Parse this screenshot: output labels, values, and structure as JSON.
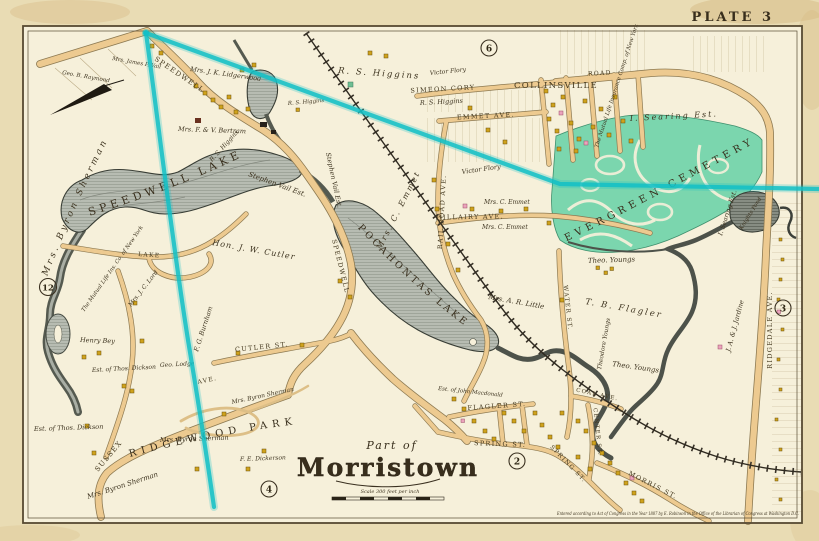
{
  "plate_label": "PLATE 3",
  "title": {
    "part_of": "Part of",
    "name": "Morristown",
    "scale_note": "Scale 300 feet per inch"
  },
  "copyright": "Entered according to Act of Congress in the Year 1887 by E. Robinson in the Office of the Librarian of Congress at Washington D.C.",
  "plate_refs": {
    "top": "6",
    "bottom": "2",
    "right": "3",
    "bottom_left": "4",
    "left": "12"
  },
  "colors": {
    "paper_margin": "#e7dab2",
    "map_background": "#f6f0da",
    "water_fill": "#b7bcb2",
    "water_dark": "#4d524a",
    "cemetery_green": "#7bd6ae",
    "road_fill": "#edca90",
    "overlay_cyan": "#12bfc6",
    "building_yellow": "#cfa21c",
    "building_pink": "#eba4bc",
    "ink": "#3a3020"
  },
  "labels": {
    "speedwell_lake": "SPEEDWELL LAKE",
    "pocahontas_lake": "POCAHONTAS LAKE",
    "evergreen_cemetery": "EVERGREEN CEMETERY",
    "ridgewood_park": "RIDGEWOOD PARK",
    "collinsville": "COLLINSVILLE",
    "knights_pond": "Knights Pond",
    "sherman_spread": "Mrs. Byron Sherman",
    "sherman1": "Mrs. Byron Sherman",
    "sherman2": "Mrs. Byron Sherman",
    "sherman3": "Mrs. Byron Sherman",
    "lidgerwood": "Mrs. J. K. Lidgerwood",
    "bertram": "Mrs. F. & V. Bertram",
    "higgins_big": "R. S. Higgins",
    "higgins2": "R. S. Higgins",
    "higgins3": "R. S. Higgins",
    "higgins4": "R. S. Higgins",
    "victor_flory1": "Victor Flory",
    "victor_flory2": "Victor Flory",
    "mutual_right": "The Mutual Life Insurance Comp. of New York",
    "mutual_left": "The Mutual Life Ins. Co. of New York",
    "searing_top": "I. Searing Est.",
    "searing_right": "I. Searing Est.",
    "stephen_vail1": "Stephen Vail Est.",
    "stephen_vail2": "Stephen Vail Est.",
    "cutler_hon": "Hon. J. W. Cutler",
    "emmet_diag": "Mrs. C. Emmet",
    "emmet_small1": "Mrs. C. Emmet",
    "emmet_small2": "Mrs. C. Emmet",
    "little": "Mrs. A. R. Little",
    "tb_flagler": "T. B. Flagler",
    "youngs1": "Theo. Youngs",
    "youngs2": "Theo. Youngs",
    "youngs_vert": "Theodore Youngs",
    "jardine": "J. A. & J. Jardine",
    "henry_bey": "Henry Bey",
    "dickson1": "Est. of Thos. Dickson",
    "dickson2": "Est. of Thos. Dickson",
    "lord": "Mrs. J. C. Lord",
    "burnham": "F. G. Burnham",
    "lodge": "Geo. Lodge",
    "macdonald": "Est. of John Macdonald",
    "dickerson": "F. E. Dickerson",
    "raymond": "Geo. B. Raymond",
    "james_vail": "Mrs. James P. Vail",
    "simeon_cory": "SIMEON CORY",
    "road_top": "ROAD",
    "emmet_ave": "EMMET AVE.",
    "hillairy_ave": "HILLAIRY AVE.",
    "railroad_ave": "RAIL ROAD AVE.",
    "speedwell_ave1": "SPEEDWELL",
    "speedwell_ave2": "SPEEDWELL",
    "ave1": "AVE.",
    "sussex": "SUSSEX",
    "lake_rd": "LAKE",
    "cutler_st": "CUTLER ST.",
    "spring_st1": "SPRING ST.",
    "spring_st2": "SPRING ST.",
    "flagler_st": "FLAGLER ST.",
    "water_st": "WATER ST.",
    "coal_ave": "COAL AVE.",
    "center_st": "CENTER ST.",
    "morris_st": "MORRIS ST.",
    "ridgedale_ave": "RIDGEDALE AVE."
  }
}
